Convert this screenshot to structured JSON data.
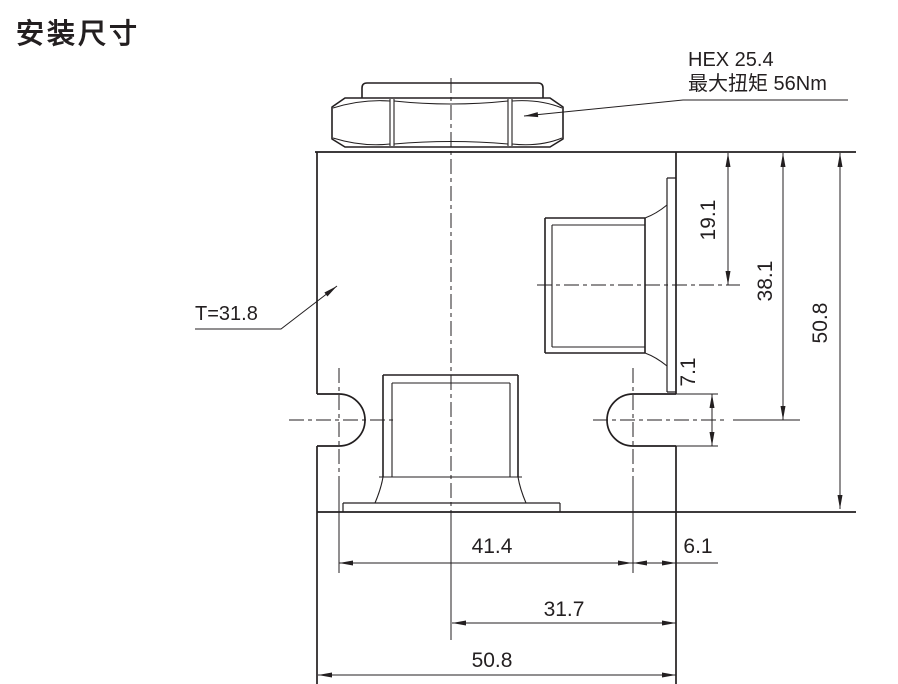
{
  "title": "安装尺寸",
  "callouts": {
    "hex": {
      "line1": "HEX 25.4",
      "line2": "最大扭矩 56Nm"
    },
    "thickness": {
      "label": "T=31.8"
    }
  },
  "dimensions": {
    "port_center_from_top": "19.1",
    "slot_center_from_top": "38.1",
    "overall_height": "50.8",
    "slot_width": "7.1",
    "slot_center_spacing": "41.4",
    "slot_center_to_edge": "6.1",
    "center_to_right_edge": "31.7",
    "overall_width": "50.8"
  },
  "colors": {
    "line": "#231f20",
    "background": "#ffffff"
  }
}
